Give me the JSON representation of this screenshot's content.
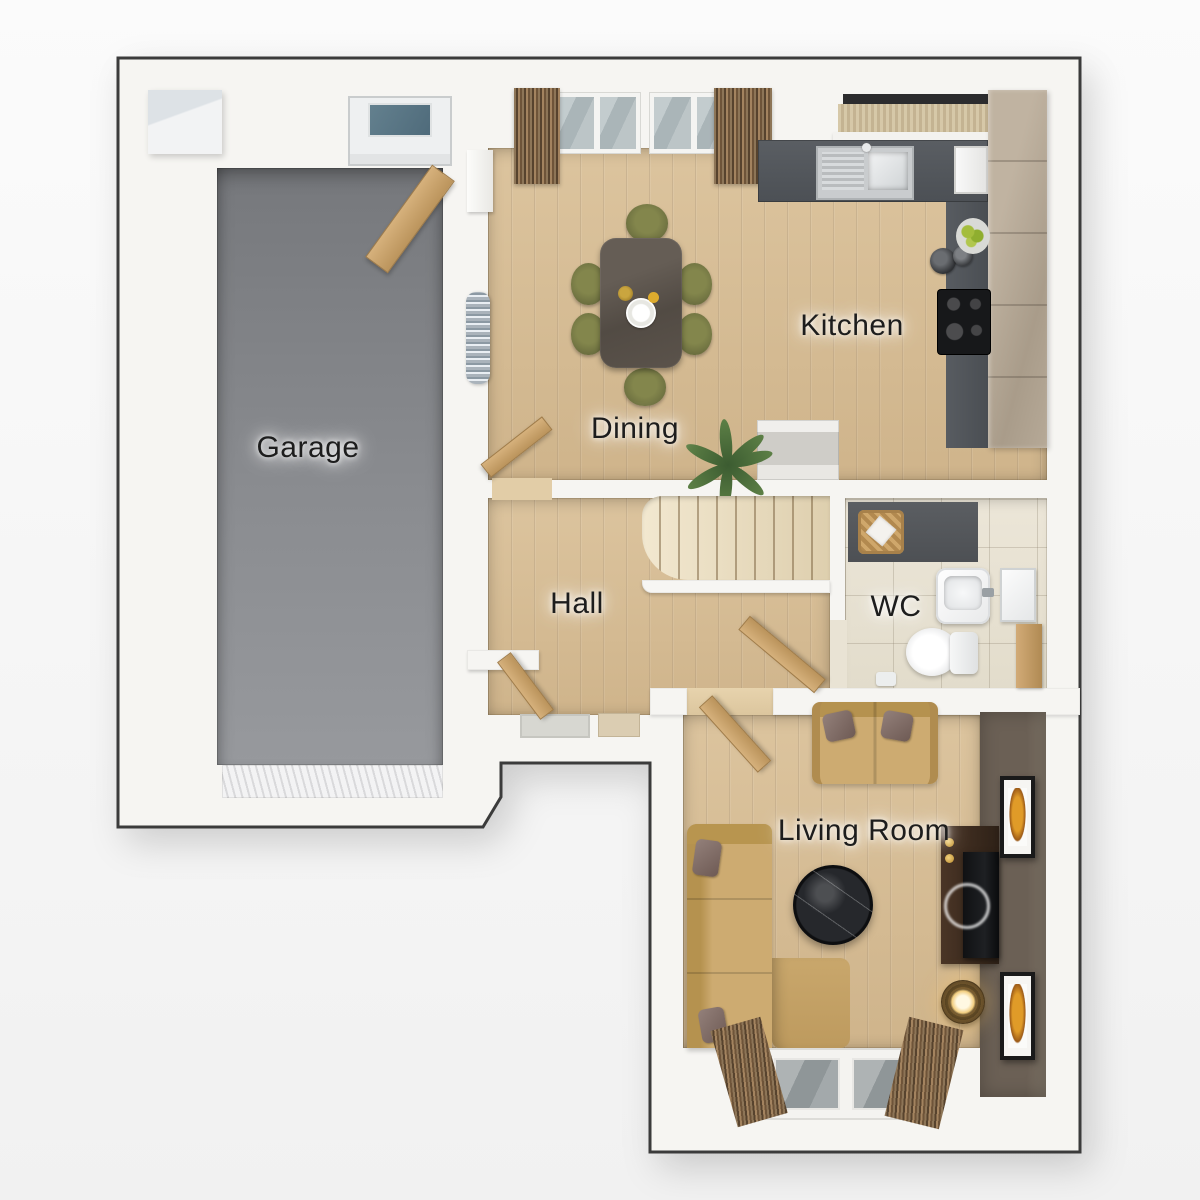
{
  "rooms": {
    "garage": {
      "label": "Garage"
    },
    "kitchen": {
      "label": "Kitchen"
    },
    "dining": {
      "label": "Dining"
    },
    "hall": {
      "label": "Hall"
    },
    "wc": {
      "label": "WC"
    },
    "living_room": {
      "label": "Living Room"
    }
  },
  "colors": {
    "background_top": "#fbfbfb",
    "background_bottom": "#f1f1f1",
    "wall_fill": "#f6f5f2",
    "outline": "#3b3b3b",
    "wood_floor": "#dcc49e",
    "garage_floor": "#8a8c90",
    "counter_dark": "#5a5e63",
    "cabinet_taupe": "#a99c8a",
    "stair_carpet": "#decfae",
    "wc_tile": "#ece6d8",
    "accent_wall": "#6b6055",
    "sofa_tan": "#cdab71",
    "chair_olive": "#6d7040",
    "table_walnut": "#524b44",
    "door_wood": "#bb945c",
    "curtain_dark": "#57432e",
    "glass": "#aab5b8",
    "label_text": "#1d1d1d"
  }
}
